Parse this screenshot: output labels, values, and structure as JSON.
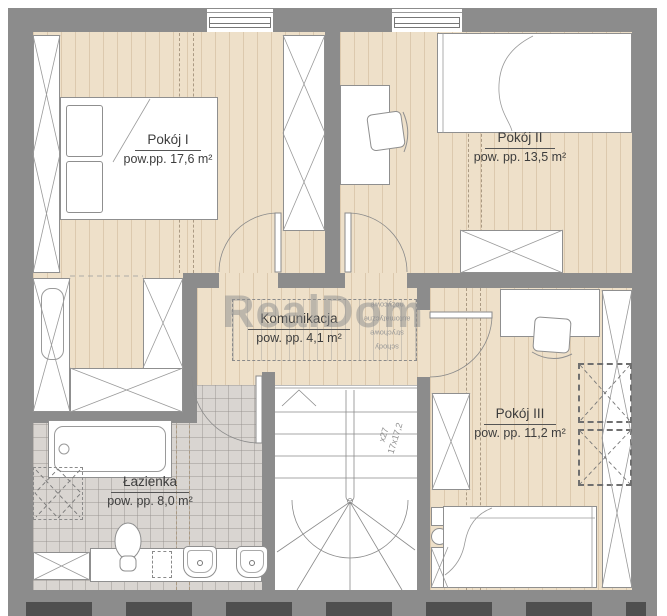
{
  "watermark": {
    "text": "RealDom"
  },
  "rooms": {
    "pokoj_i": {
      "name": "Pokój I",
      "area": "pow.pp. 17,6 m²"
    },
    "pokoj_ii": {
      "name": "Pokój II",
      "area": "pow. pp. 13,5 m²"
    },
    "komunikacja": {
      "name": "Komunikacja",
      "area": "pow. pp. 4,1 m²"
    },
    "lazienka": {
      "name": "Łazienka",
      "area": "pow. pp. 8,0 m²"
    },
    "pokoj_iii": {
      "name": "Pokój III",
      "area": "pow. pp. 11,2 m²"
    }
  },
  "annotations": {
    "stairs_spec": [
      "x27",
      "17x17,2"
    ],
    "attic_stairs": [
      "schody",
      "strychowe",
      "automatyczne",
      "nożycowe"
    ]
  },
  "colors": {
    "wall": "#8c8c8c",
    "wood_floor": "#eee0c9",
    "tile_floor": "#d9d5d1",
    "furniture_outline": "#8f8f8f",
    "label_text": "#3d3d3d",
    "watermark": "#909090"
  }
}
